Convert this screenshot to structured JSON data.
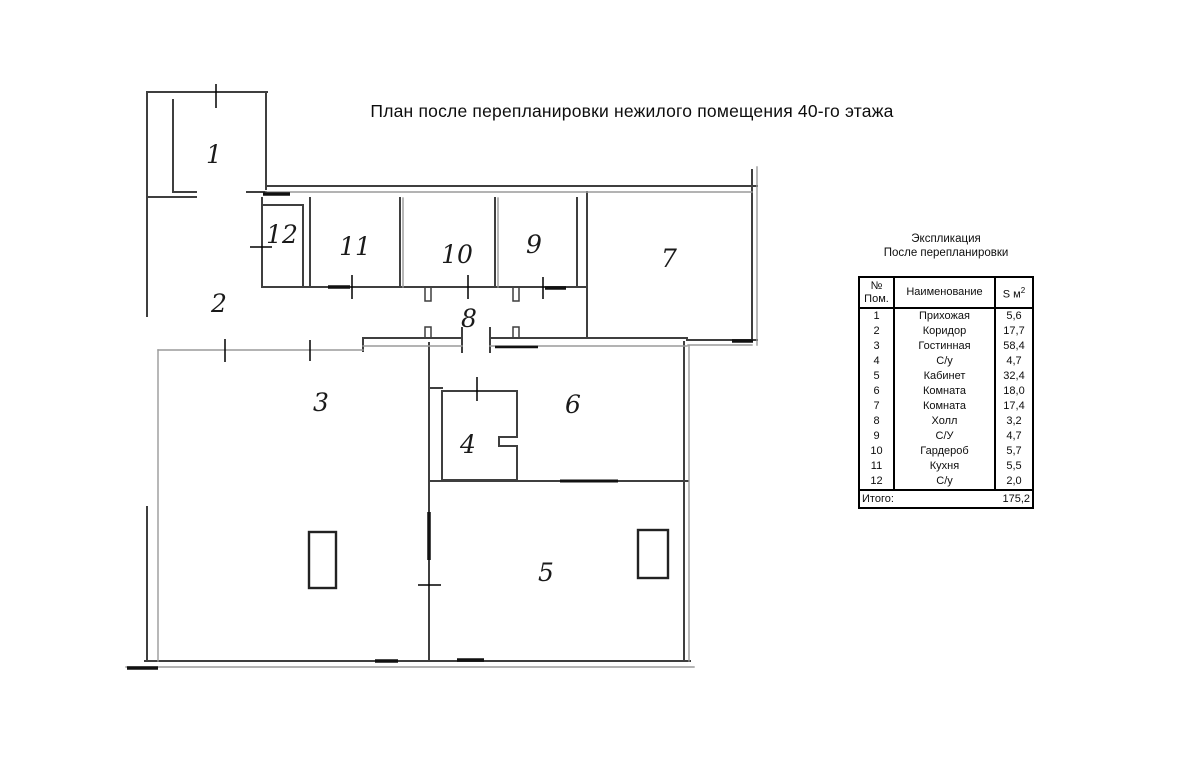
{
  "title": "План после перепланировки нежилого помещения 40-го этажа",
  "plan": {
    "rooms": [
      {
        "number": "1"
      },
      {
        "number": "2"
      },
      {
        "number": "3"
      },
      {
        "number": "4"
      },
      {
        "number": "5"
      },
      {
        "number": "6"
      },
      {
        "number": "7"
      },
      {
        "number": "8"
      },
      {
        "number": "9"
      },
      {
        "number": "10"
      },
      {
        "number": "11"
      },
      {
        "number": "12"
      }
    ]
  },
  "legend": {
    "caption_line1": "Экспликация",
    "caption_line2": "После перепланировки",
    "columns": {
      "num_line1": "№",
      "num_line2": "Пом.",
      "name": "Наименование",
      "area_label": "S м",
      "area_sup": "2"
    },
    "rows": [
      {
        "num": "1",
        "name": "Прихожая",
        "area": "5,6"
      },
      {
        "num": "2",
        "name": "Коридор",
        "area": "17,7"
      },
      {
        "num": "3",
        "name": "Гостинная",
        "area": "58,4"
      },
      {
        "num": "4",
        "name": "С/у",
        "area": "4,7"
      },
      {
        "num": "5",
        "name": "Кабинет",
        "area": "32,4"
      },
      {
        "num": "6",
        "name": "Комната",
        "area": "18,0"
      },
      {
        "num": "7",
        "name": "Комната",
        "area": "17,4"
      },
      {
        "num": "8",
        "name": "Холл",
        "area": "3,2"
      },
      {
        "num": "9",
        "name": "С/У",
        "area": "4,7"
      },
      {
        "num": "10",
        "name": "Гардероб",
        "area": "5,7"
      },
      {
        "num": "11",
        "name": "Кухня",
        "area": "5,5"
      },
      {
        "num": "12",
        "name": "С/у",
        "area": "2,0"
      }
    ],
    "total_label": "Итого:",
    "total_value": "175,2"
  },
  "colors": {
    "wall_dark": "#3f3f3f",
    "wall_gray": "#9a9a9a",
    "ink": "#111111"
  }
}
